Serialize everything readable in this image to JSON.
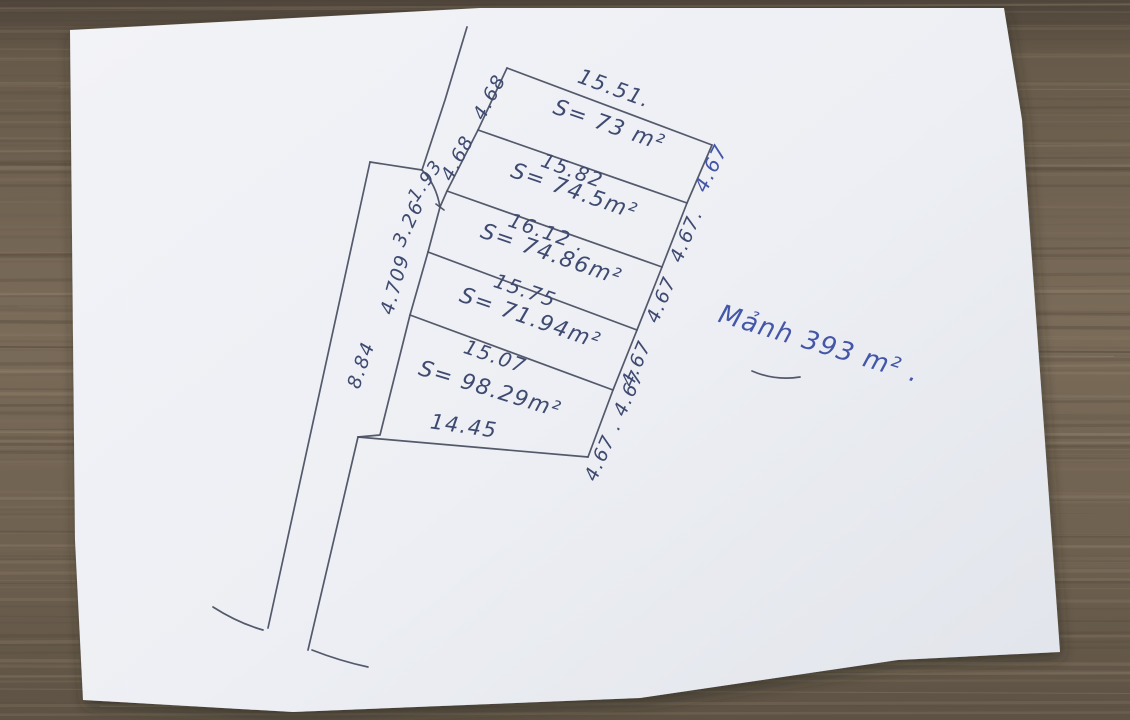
{
  "colors": {
    "ink_line": "#4b5063",
    "ink_text": "#3e4a70",
    "ink_blue_pen": "#4456a8",
    "paper": "#eef0f4",
    "wood": "#6f6150"
  },
  "sketch": {
    "total_note": "Mảnh 393 m² .",
    "bottom_edge_length": "14.45",
    "parcels": [
      {
        "top_length": "15.51.",
        "area": "S= 73 m²",
        "left": "4.68",
        "right": "4.67"
      },
      {
        "top_length": "15.82",
        "area": "S= 74.5m²",
        "left": "4.68",
        "right": "4.67."
      },
      {
        "top_length": "16.12 .",
        "area": "S= 74.86m²",
        "left_upper": "1.93",
        "left_lower": "3.26",
        "right": "4.67"
      },
      {
        "top_length": "15.75",
        "area": "S= 71.94m²",
        "left": "4.709",
        "right": "4.67"
      },
      {
        "top_length": "15.07",
        "area": "S= 98.29m²",
        "left": "8.84",
        "right": "4.67 . 4.67"
      }
    ]
  }
}
